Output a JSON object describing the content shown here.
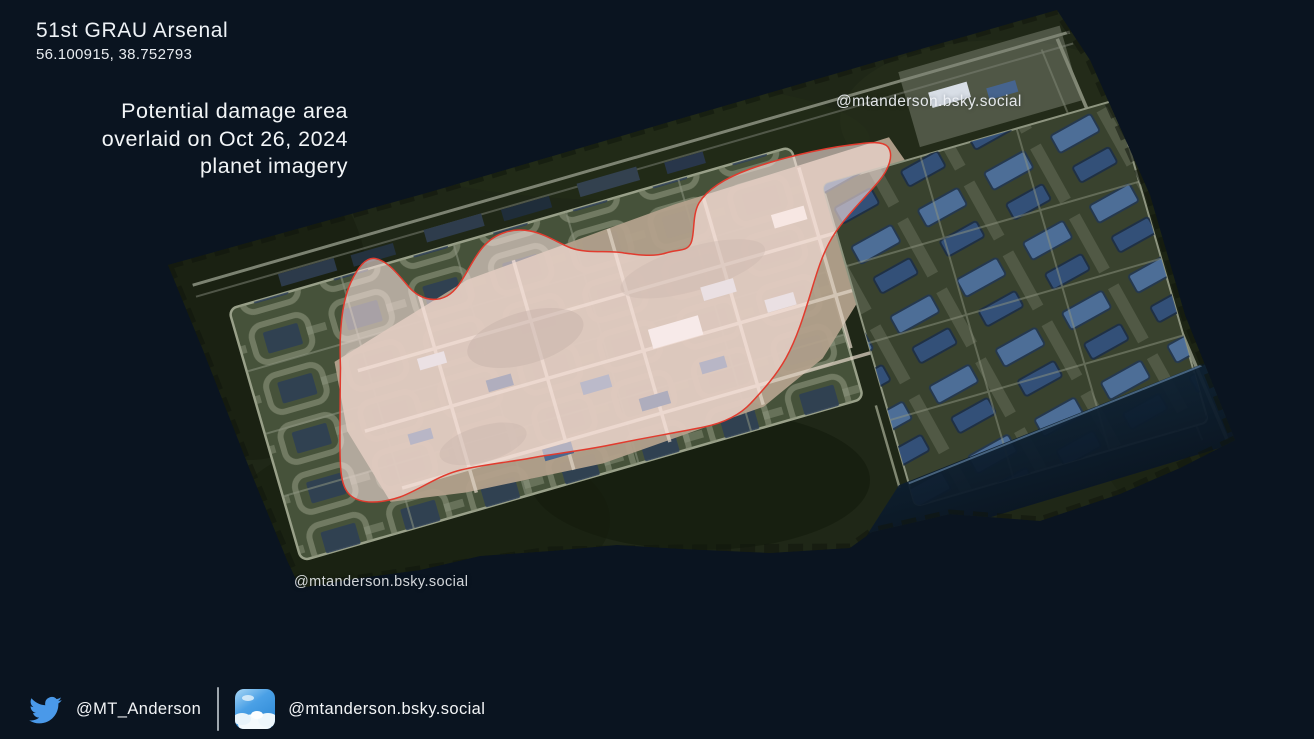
{
  "header": {
    "title": "51st GRAU Arsenal",
    "coordinates": "56.100915, 38.752793",
    "caption": [
      "Potential damage area",
      "overlaid on Oct 26, 2024",
      "planet imagery"
    ]
  },
  "watermarks": {
    "top": "@mtanderson.bsky.social",
    "bottom": "@mtanderson.bsky.social"
  },
  "footer": {
    "twitter_handle": "@MT_Anderson",
    "bluesky_handle": "@mtanderson.bsky.social",
    "twitter_icon": "twitter-bird",
    "bluesky_icon": "bluesky-sky-app-icon"
  },
  "overlay": {
    "label": "potential-damage-area",
    "imagery_date": "Oct 26, 2024",
    "imagery_source": "planet imagery"
  },
  "colors": {
    "background": "#0a1420",
    "damage_fill": "#ffe7e3",
    "damage_outline": "#e13b2e",
    "twitter_blue": "#4a99e9"
  }
}
